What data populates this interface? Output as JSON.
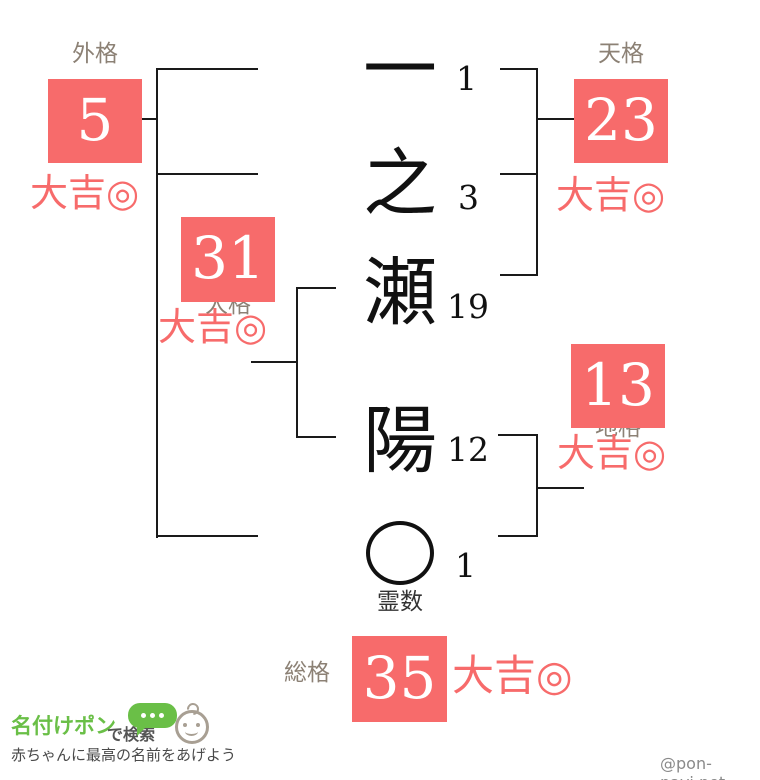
{
  "name": {
    "chars": [
      {
        "glyph": "一",
        "strokes": "1"
      },
      {
        "glyph": "之",
        "strokes": "3"
      },
      {
        "glyph": "瀬",
        "strokes": "19"
      },
      {
        "glyph": "陽",
        "strokes": "12"
      }
    ],
    "reisu": {
      "strokes": "1",
      "label": "霊数",
      "icon": "circle-icon"
    }
  },
  "scores": {
    "gaikaku": {
      "label": "外格",
      "value": "5",
      "fortune": "大吉◎"
    },
    "tenkaku": {
      "label": "天格",
      "value": "23",
      "fortune": "大吉◎"
    },
    "jinkaku": {
      "label": "人格",
      "value": "31",
      "fortune": "大吉◎"
    },
    "chikaku": {
      "label": "地格",
      "value": "13",
      "fortune": "大吉◎"
    },
    "soukaku": {
      "label": "総格",
      "value": "35",
      "fortune": "大吉◎"
    }
  },
  "footer": {
    "logo_text": "名付けポン",
    "logo_suffix": "で検索",
    "bubble_icon": "speech-bubble-icon",
    "baby_icon": "baby-face-icon",
    "tagline": "赤ちゃんに最高の名前をあげよう",
    "credit": "@pon-navi.net"
  },
  "colors": {
    "accent": "#f76b6b",
    "label_gray": "#8c8175",
    "logo_green": "#6abf47",
    "line_black": "#1a1a1a"
  }
}
